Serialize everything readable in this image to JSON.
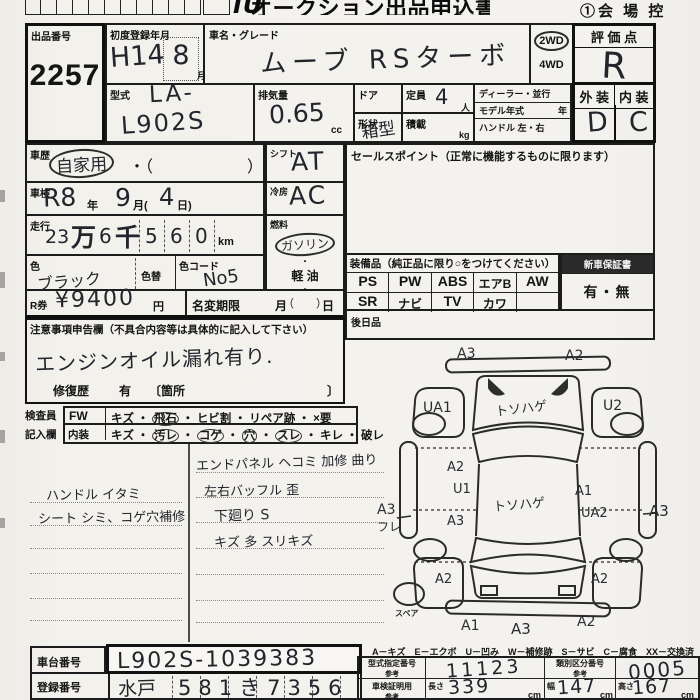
{
  "page": {
    "title_partial": "オークション出品申込書",
    "logo": "JU",
    "corner_note": "①会 場 控"
  },
  "header": {
    "lot": {
      "label": "出品番号",
      "value": "2257"
    },
    "first_reg": {
      "label": "初度登録年月",
      "era_year": "H14",
      "month": "8",
      "month_unit": "月"
    },
    "car_name": {
      "label": "車名・グレード",
      "value": "ムーブ RSターボ"
    },
    "drive": {
      "opt_2wd": "2WD",
      "opt_4wd": "4WD"
    },
    "score": {
      "label": "評 価 点",
      "value": "R"
    },
    "model_code": {
      "label": "型式",
      "prefix": "LA-",
      "value": "L902S"
    },
    "displacement": {
      "label": "排気量",
      "value": "0.65",
      "unit": "cc"
    },
    "doors": {
      "label": "ドア"
    },
    "capacity": {
      "label": "定員",
      "value": "4",
      "unit": "人"
    },
    "shape": {
      "label": "形状",
      "value": "箱型"
    },
    "load": {
      "label": "積載",
      "unit": "kg"
    },
    "dealer": {
      "row1": "ディーラー・並行",
      "row2_label": "モデル年式",
      "row2_unit": "年",
      "row3": "ハンドル 左・右"
    },
    "exterior": {
      "label": "外 装",
      "value": "D"
    },
    "interior": {
      "label": "内 装",
      "value": "C"
    }
  },
  "left": {
    "history": {
      "label": "車歴",
      "value": "自家用",
      "paren_open": "・（",
      "paren_close": "）"
    },
    "shaken": {
      "label": "車検",
      "value": "R8",
      "y_unit": "年",
      "m": "9",
      "m_unit": "月(",
      "d": "4",
      "d_unit": "日)"
    },
    "mileage": {
      "label": "走行",
      "p1": "23",
      "p2": "万",
      "p3": "6",
      "p4": "千",
      "p5": "5",
      "p6": "6",
      "p7": "0",
      "unit": "km"
    },
    "color": {
      "label": "色",
      "value": "ブラック",
      "change_label": "色替",
      "code_label": "色コード",
      "code": "No5"
    },
    "rticket": {
      "label": "R券",
      "value": "¥9400",
      "unit": "円",
      "deadline_label": "名変期限",
      "month": "月",
      "day": "日"
    },
    "shift": {
      "label": "シフト",
      "value": "AT"
    },
    "ac": {
      "label": "冷房",
      "value": "AC"
    },
    "fuel": {
      "label": "燃料",
      "opt1": "ガソリン",
      "sep": "・",
      "opt2": "軽 油",
      "opt3": "（　　）"
    }
  },
  "right": {
    "sales_label": "セールスポイント（正常に機能するものに限ります）",
    "equipment": {
      "label": "装備品（純正品に限り○をつけてください）",
      "row1": [
        "PS",
        "PW",
        "ABS",
        "エアB",
        "AW"
      ],
      "row2": [
        "SR",
        "ナビ",
        "TV",
        "カワ",
        ""
      ]
    },
    "warranty": {
      "label": "新車保証書",
      "value": "有・無"
    },
    "later_label": "後日品"
  },
  "caution": {
    "label": "注意事項申告欄（不具合内容等は具体的に記入して下さい）",
    "note": "エンジンオイル漏れ有り.",
    "repair_label": "修復歴",
    "repair_value": "有",
    "repair_open": "〔箇所",
    "repair_close": "〕"
  },
  "inspector": {
    "head1": "検査員",
    "head2": "記入欄",
    "sep": "・",
    "fw_label": "FW",
    "fw_items": [
      "キズ",
      "飛石",
      "ヒビ割",
      "リペア跡",
      "×要"
    ],
    "int_label": "内装",
    "int_items": [
      "キズ",
      "汚レ",
      "コゲ",
      "穴",
      "スレ",
      "キレ",
      "破レ"
    ]
  },
  "notes": {
    "left": [
      "ハンドル イタミ",
      "シート シミ、コゲ穴補修"
    ],
    "right": [
      "エンドパネル ヘコミ 加修 曲り",
      "左右バッフル 歪",
      "下廻り S",
      "キズ 多 スリキズ"
    ]
  },
  "diagram": {
    "front_left": "A3",
    "front_right": "A2",
    "fender_fl": "UA1",
    "fender_fr": "U2",
    "hood": "トソハゲ",
    "roof": "トソハゲ",
    "side_l1": "A2",
    "side_l2": "U1",
    "side_l3": "A3",
    "out_left": "A3",
    "out_left2": "フレ",
    "side_r1": "A1",
    "side_r2": "UA2",
    "out_right": "A3",
    "quarter_l": "A2",
    "quarter_r": "A2",
    "rear1": "A1",
    "rear2": "A3",
    "rear3": "A2",
    "spare": "スペア",
    "legend": "A－キズ　E－エクボ　U－凹み　W－補修跡　S－サビ　C－腐食　XX－交換済"
  },
  "bottom": {
    "chassis": {
      "label": "車台番号",
      "value": "L902S-1039383"
    },
    "plate": {
      "label": "登録番号",
      "prefix": "水戸",
      "value": "581き7356"
    },
    "spec": {
      "model_no_label": "型式指定番号",
      "ref": "参考",
      "model_no": "11123",
      "class_no_label": "類別区分番号",
      "class_no": "0005",
      "cert_label": "車検証明用",
      "length_label": "長さ",
      "length": "339",
      "width_label": "幅",
      "width": "147",
      "height_label": "高さ",
      "height": "167",
      "cm": "cm"
    }
  }
}
